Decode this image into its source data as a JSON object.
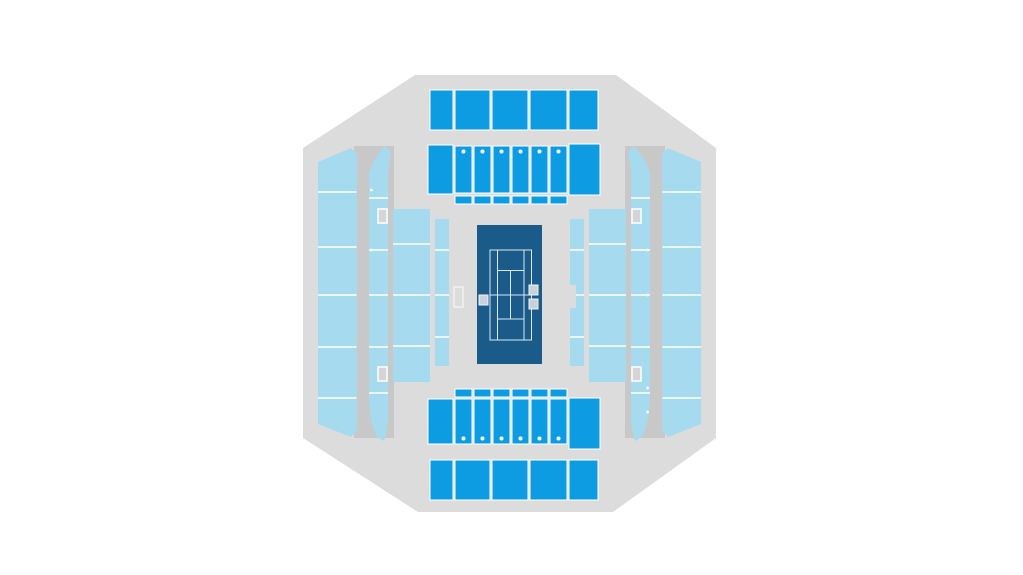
{
  "app": {
    "name": "Stadium seating map",
    "background": "#ffffff"
  },
  "colors": {
    "background": "#ffffff",
    "stadium": "#dcdcdc",
    "aisle": "#c8c8c8",
    "sectionLight": "#a6daee",
    "sectionBright": "#0d9ce2",
    "court": "#1b5b8a",
    "courtLine": "#d9e8f2",
    "divider": "#ffffff",
    "marker": "#d5d5d5",
    "markerStroke": "#ffffff",
    "courtMarker": "#c9d2d8",
    "courtMarkerStroke": "#eef4f8"
  },
  "map": {
    "shape": "octagon",
    "court": {
      "sport": "tennis",
      "orientation": "vertical",
      "side_markers": 3
    },
    "stands": [
      {
        "id": "north-upper",
        "tier": "bright",
        "blocks": 5
      },
      {
        "id": "north-lower",
        "tier": "bright",
        "blocks": 8,
        "aisle_dots": 6
      },
      {
        "id": "north-rail",
        "tier": "bright",
        "blocks": 6
      },
      {
        "id": "south-rail",
        "tier": "bright",
        "blocks": 6
      },
      {
        "id": "south-lower",
        "tier": "bright",
        "blocks": 8,
        "aisle_dots": 6
      },
      {
        "id": "south-upper",
        "tier": "bright",
        "blocks": 5
      },
      {
        "id": "west-upper",
        "tier": "light",
        "rows": 6
      },
      {
        "id": "west-lower",
        "tier": "light",
        "rows": 6
      },
      {
        "id": "west-courtside-outer",
        "tier": "light",
        "rows": 4
      },
      {
        "id": "west-courtside-inner",
        "tier": "light",
        "rows": 4
      },
      {
        "id": "east-courtside-inner",
        "tier": "light",
        "rows": 4
      },
      {
        "id": "east-courtside-outer",
        "tier": "light",
        "rows": 4
      },
      {
        "id": "east-lower",
        "tier": "light",
        "rows": 6
      },
      {
        "id": "east-upper",
        "tier": "light",
        "rows": 6
      }
    ],
    "entrances": 4
  }
}
